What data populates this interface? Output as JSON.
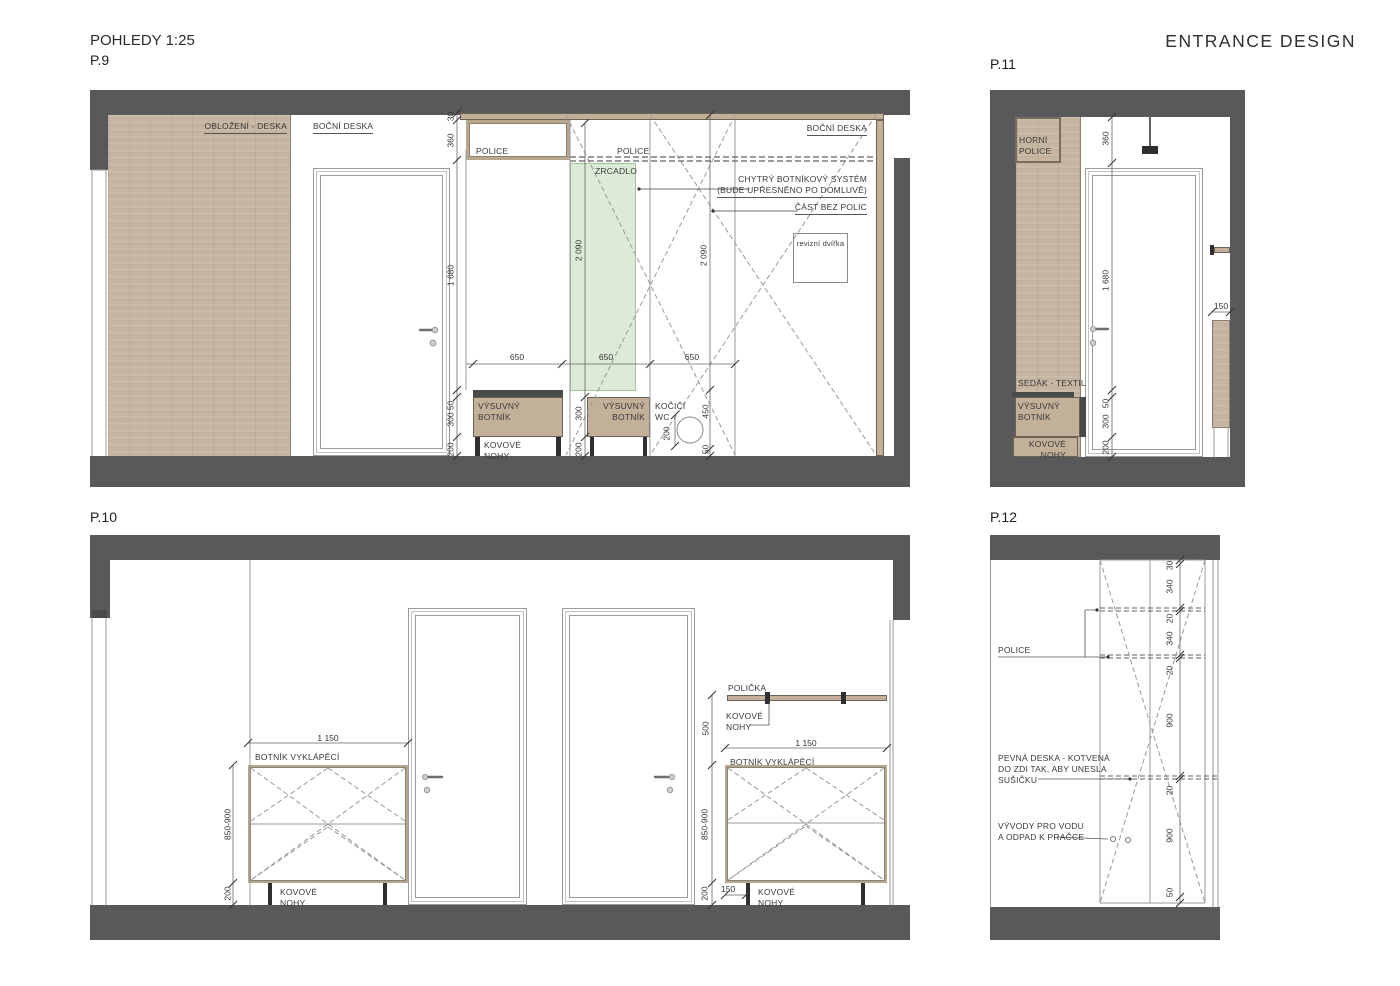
{
  "header": {
    "title": "POHLEDY 1:25",
    "brand": "ENTRANCE DESIGN"
  },
  "panels": {
    "p9": "P.9",
    "p10": "P.10",
    "p11": "P.11",
    "p12": "P.12"
  },
  "labels": {
    "oblozeni": "OBLOŽENÍ - DESKA",
    "bocni_deska": "BOČNÍ DESKA",
    "police": "POLICE",
    "zrcadlo": "ZRCADLO",
    "chytry": "CHYTRÝ BOTNÍKOVÝ SYSTÉM\n(BUDE UPŘESNĚNO PO DOMLUVĚ)",
    "cast_bez_polic": "ČÁST BEZ POLIC",
    "revizni": "revizní dvířka",
    "vysuvny_botnik": "VÝSUVNÝ\nBOTNÍK",
    "kovove_nohy": "KOVOVÉ\nNOHY",
    "kocici_wc": "KOČIČÍ\nWC",
    "horni_police": "HORNÍ\nPOLICE",
    "sedak": "SEDÁK - TEXTIL",
    "botnik_vyklapeci": "BOTNÍK VYKLÁPĚCÍ",
    "policka": "POLIČKA",
    "pevna_deska": "PEVNÁ DESKA - KOTVENÁ\nDO ZDI TAK, ABY UNESLA\nSUŠIČKU",
    "vyvody": "VÝVODY PRO VODU\nA ODPAD K PRAČCE"
  },
  "dims": {
    "d30": "30",
    "d360": "360",
    "d1680": "1 680",
    "d2090": "2 090",
    "d650": "650",
    "d50": "50",
    "d300": "300",
    "d200": "200",
    "d450": "450",
    "d1150": "1 150",
    "d850": "850-900",
    "d500": "500",
    "d150": "150",
    "d340": "340",
    "d20": "20",
    "d900": "900"
  },
  "colors": {
    "wall": "#59585a",
    "wood": "#c6b5a0",
    "mirror": "#dcead6",
    "hardware": "#3c3c3e"
  }
}
